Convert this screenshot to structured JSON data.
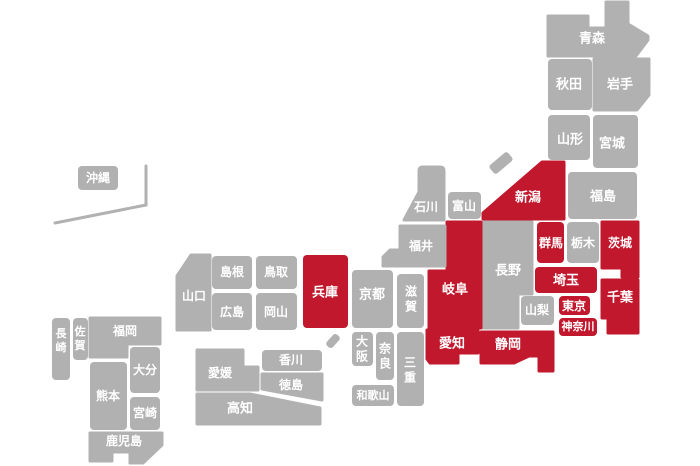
{
  "map": {
    "background": "#ffffff",
    "colors": {
      "prefecture_default": "#b1b1b1",
      "prefecture_highlight": "#c2182d",
      "label_text": "#ffffff",
      "okinawa_line": "#b1b1b1"
    },
    "highlighted_prefectures": [
      "新潟",
      "群馬",
      "茨城",
      "埼玉",
      "東京",
      "神奈川",
      "千葉",
      "静岡",
      "愛知",
      "岐阜",
      "兵庫"
    ],
    "prefectures": [
      {
        "id": "aomori",
        "name": "青森",
        "highlight": false,
        "shape": {
          "type": "path",
          "d": "M548,16 H588 V28 H606 V2 H628 V24 L648,36 V40 L636,56 H548 Z"
        },
        "label": {
          "x": 592,
          "y": 38,
          "fs": 13,
          "orient": "h"
        }
      },
      {
        "id": "akita",
        "name": "秋田",
        "highlight": false,
        "shape": {
          "type": "rect",
          "x": 548,
          "y": 59,
          "w": 44,
          "h": 51
        },
        "label": {
          "x": 569,
          "y": 84,
          "fs": 13,
          "orient": "h"
        }
      },
      {
        "id": "iwate",
        "name": "岩手",
        "highlight": false,
        "shape": {
          "type": "path",
          "d": "M594,59 H649 V95 L637,110 H594 Z"
        },
        "label": {
          "x": 620,
          "y": 84,
          "fs": 13,
          "orient": "h"
        }
      },
      {
        "id": "yamagata",
        "name": "山形",
        "highlight": false,
        "shape": {
          "type": "rect",
          "x": 548,
          "y": 115,
          "w": 42,
          "h": 45
        },
        "label": {
          "x": 570,
          "y": 139,
          "fs": 13,
          "orient": "h"
        }
      },
      {
        "id": "miyagi",
        "name": "宮城",
        "highlight": false,
        "shape": {
          "type": "rect",
          "x": 593,
          "y": 115,
          "w": 45,
          "h": 53
        },
        "label": {
          "x": 612,
          "y": 143,
          "fs": 13,
          "orient": "h"
        }
      },
      {
        "id": "fukushima",
        "name": "福島",
        "highlight": false,
        "shape": {
          "type": "rect",
          "x": 568,
          "y": 172,
          "w": 69,
          "h": 47
        },
        "label": {
          "x": 603,
          "y": 196,
          "fs": 13,
          "orient": "h"
        }
      },
      {
        "id": "niigata",
        "name": "新潟",
        "highlight": true,
        "shape": {
          "type": "path",
          "d": "M483,213 L542,162 H564 V219 H483 Z"
        },
        "label": {
          "x": 528,
          "y": 197,
          "fs": 13,
          "orient": "h"
        }
      },
      {
        "id": "gunma",
        "name": "群馬",
        "highlight": true,
        "shape": {
          "type": "rect",
          "x": 537,
          "y": 222,
          "w": 27,
          "h": 41
        },
        "label": {
          "x": 551,
          "y": 243,
          "fs": 12,
          "orient": "h"
        }
      },
      {
        "id": "tochigi",
        "name": "栃木",
        "highlight": false,
        "shape": {
          "type": "rect",
          "x": 567,
          "y": 222,
          "w": 32,
          "h": 41
        },
        "label": {
          "x": 583,
          "y": 243,
          "fs": 12,
          "orient": "h"
        }
      },
      {
        "id": "ibaraki",
        "name": "茨城",
        "highlight": true,
        "shape": {
          "type": "path",
          "d": "M602,222 H638 V277 H622 V268 H602 Z"
        },
        "label": {
          "x": 620,
          "y": 243,
          "fs": 12,
          "orient": "h"
        }
      },
      {
        "id": "saitama",
        "name": "埼玉",
        "highlight": true,
        "shape": {
          "type": "rect",
          "x": 535,
          "y": 267,
          "w": 62,
          "h": 26
        },
        "label": {
          "x": 566,
          "y": 280,
          "fs": 13,
          "orient": "h"
        }
      },
      {
        "id": "tokyo",
        "name": "東京",
        "highlight": true,
        "shape": {
          "type": "rect",
          "x": 559,
          "y": 296,
          "w": 31,
          "h": 19
        },
        "label": {
          "x": 574,
          "y": 306,
          "fs": 12,
          "orient": "h"
        }
      },
      {
        "id": "kanagawa",
        "name": "神奈川",
        "highlight": true,
        "shape": {
          "type": "rect",
          "x": 559,
          "y": 318,
          "w": 38,
          "h": 18
        },
        "label": {
          "x": 578,
          "y": 327,
          "fs": 11,
          "orient": "h"
        }
      },
      {
        "id": "chiba",
        "name": "千葉",
        "highlight": true,
        "shape": {
          "type": "path",
          "d": "M602,280 H638 V333 H608 V318 H602 Z"
        },
        "label": {
          "x": 620,
          "y": 297,
          "fs": 13,
          "orient": "h"
        }
      },
      {
        "id": "yamanashi",
        "name": "山梨",
        "highlight": false,
        "shape": {
          "type": "rect",
          "x": 521,
          "y": 296,
          "w": 33,
          "h": 29
        },
        "label": {
          "x": 537,
          "y": 310,
          "fs": 12,
          "orient": "h"
        }
      },
      {
        "id": "nagano",
        "name": "長野",
        "highlight": false,
        "shape": {
          "type": "path",
          "d": "M483,222 H532 V294 H518 V328 H483 Z"
        },
        "label": {
          "x": 508,
          "y": 270,
          "fs": 13,
          "orient": "h"
        }
      },
      {
        "id": "gifu",
        "name": "岐阜",
        "highlight": true,
        "shape": {
          "type": "path",
          "d": "M447,222 H481 V328 H429 V271 H447 Z"
        },
        "label": {
          "x": 455,
          "y": 289,
          "fs": 13,
          "orient": "h"
        }
      },
      {
        "id": "shizuoka",
        "name": "静岡",
        "highlight": true,
        "shape": {
          "type": "path",
          "d": "M481,332 H553 V371 H539 V356 H529 L514,363 H481 Z"
        },
        "label": {
          "x": 508,
          "y": 344,
          "fs": 13,
          "orient": "h"
        }
      },
      {
        "id": "aichi",
        "name": "愛知",
        "highlight": true,
        "shape": {
          "type": "path",
          "d": "M427,330 H478 V353 H458 V363 H430 L427,359 Z"
        },
        "label": {
          "x": 452,
          "y": 343,
          "fs": 13,
          "orient": "h"
        }
      },
      {
        "id": "toyama",
        "name": "富山",
        "highlight": false,
        "shape": {
          "type": "rect",
          "x": 448,
          "y": 192,
          "w": 33,
          "h": 27
        },
        "label": {
          "x": 464,
          "y": 206,
          "fs": 12,
          "orient": "h"
        }
      },
      {
        "id": "ishikawa",
        "name": "石川",
        "highlight": false,
        "shape": {
          "type": "path",
          "d": "M404,220 L419,192 V171 Q419,167 423,167 H440 Q444,167 444,171 V220 Z"
        },
        "label": {
          "x": 426,
          "y": 207,
          "fs": 12,
          "orient": "h"
        }
      },
      {
        "id": "fukui",
        "name": "福井",
        "highlight": false,
        "shape": {
          "type": "path",
          "d": "M400,226 H445 V266 H383 V257 L390,250 H400 Z"
        },
        "label": {
          "x": 421,
          "y": 246,
          "fs": 12,
          "orient": "h"
        }
      },
      {
        "id": "shiga",
        "name": "滋賀",
        "highlight": false,
        "shape": {
          "type": "rect",
          "x": 397,
          "y": 274,
          "w": 27,
          "h": 54
        },
        "label": {
          "x": 411,
          "y": 299,
          "fs": 12,
          "orient": "v"
        }
      },
      {
        "id": "kyoto",
        "name": "京都",
        "highlight": false,
        "shape": {
          "type": "rect",
          "x": 352,
          "y": 270,
          "w": 41,
          "h": 58
        },
        "label": {
          "x": 372,
          "y": 294,
          "fs": 13,
          "orient": "h"
        }
      },
      {
        "id": "osaka",
        "name": "大阪",
        "highlight": false,
        "shape": {
          "type": "rect",
          "x": 352,
          "y": 332,
          "w": 21,
          "h": 34
        },
        "label": {
          "x": 362,
          "y": 349,
          "fs": 12,
          "orient": "v"
        }
      },
      {
        "id": "nara",
        "name": "奈良",
        "highlight": false,
        "shape": {
          "type": "rect",
          "x": 376,
          "y": 332,
          "w": 18,
          "h": 48
        },
        "label": {
          "x": 385,
          "y": 356,
          "fs": 12,
          "orient": "v"
        }
      },
      {
        "id": "wakayama",
        "name": "和歌山",
        "highlight": false,
        "shape": {
          "type": "rect",
          "x": 352,
          "y": 385,
          "w": 42,
          "h": 21
        },
        "label": {
          "x": 373,
          "y": 396,
          "fs": 11,
          "orient": "h"
        }
      },
      {
        "id": "mie",
        "name": "三重",
        "highlight": false,
        "shape": {
          "type": "rect",
          "x": 397,
          "y": 332,
          "w": 27,
          "h": 74
        },
        "label": {
          "x": 410,
          "y": 370,
          "fs": 12,
          "orient": "v"
        }
      },
      {
        "id": "hyogo",
        "name": "兵庫",
        "highlight": true,
        "shape": {
          "type": "rect",
          "x": 303,
          "y": 255,
          "w": 45,
          "h": 73
        },
        "label": {
          "x": 325,
          "y": 292,
          "fs": 13,
          "orient": "h"
        }
      },
      {
        "id": "tottori",
        "name": "鳥取",
        "highlight": false,
        "shape": {
          "type": "rect",
          "x": 256,
          "y": 256,
          "w": 41,
          "h": 33
        },
        "label": {
          "x": 276,
          "y": 272,
          "fs": 12,
          "orient": "h"
        }
      },
      {
        "id": "shimane",
        "name": "島根",
        "highlight": false,
        "shape": {
          "type": "rect",
          "x": 212,
          "y": 256,
          "w": 40,
          "h": 33
        },
        "label": {
          "x": 232,
          "y": 272,
          "fs": 12,
          "orient": "h"
        }
      },
      {
        "id": "okayama",
        "name": "岡山",
        "highlight": false,
        "shape": {
          "type": "rect",
          "x": 256,
          "y": 293,
          "w": 41,
          "h": 37
        },
        "label": {
          "x": 276,
          "y": 312,
          "fs": 12,
          "orient": "h"
        }
      },
      {
        "id": "hiroshima",
        "name": "広島",
        "highlight": false,
        "shape": {
          "type": "rect",
          "x": 212,
          "y": 293,
          "w": 40,
          "h": 37
        },
        "label": {
          "x": 232,
          "y": 312,
          "fs": 12,
          "orient": "h"
        }
      },
      {
        "id": "yamaguchi",
        "name": "山口",
        "highlight": false,
        "shape": {
          "type": "path",
          "d": "M191,255 H210 V330 H177 V276 Z"
        },
        "label": {
          "x": 194,
          "y": 296,
          "fs": 12,
          "orient": "h"
        }
      },
      {
        "id": "kagawa",
        "name": "香川",
        "highlight": false,
        "shape": {
          "type": "rect",
          "x": 262,
          "y": 350,
          "w": 60,
          "h": 21
        },
        "label": {
          "x": 291,
          "y": 360,
          "fs": 12,
          "orient": "h"
        }
      },
      {
        "id": "tokushima",
        "name": "徳島",
        "highlight": false,
        "shape": {
          "type": "path",
          "d": "M262,374 H322 V400 L262,389 Z"
        },
        "label": {
          "x": 291,
          "y": 385,
          "fs": 12,
          "orient": "h"
        }
      },
      {
        "id": "ehime",
        "name": "愛媛",
        "highlight": false,
        "shape": {
          "type": "path",
          "d": "M197,350 H243 V367 H258 V390 H197 Z"
        },
        "label": {
          "x": 220,
          "y": 373,
          "fs": 12,
          "orient": "h"
        }
      },
      {
        "id": "kochi",
        "name": "高知",
        "highlight": false,
        "shape": {
          "type": "path",
          "d": "M197,394 H250 L320,408 V424 H197 Z"
        },
        "label": {
          "x": 240,
          "y": 408,
          "fs": 13,
          "orient": "h"
        }
      },
      {
        "id": "fukuoka",
        "name": "福岡",
        "highlight": false,
        "shape": {
          "type": "path",
          "d": "M90,318 H160 V344 H127 V357 H90 Z"
        },
        "label": {
          "x": 125,
          "y": 331,
          "fs": 12,
          "orient": "h"
        }
      },
      {
        "id": "saga",
        "name": "佐賀",
        "highlight": false,
        "shape": {
          "type": "rect",
          "x": 73,
          "y": 318,
          "w": 15,
          "h": 42
        },
        "label": {
          "x": 80,
          "y": 339,
          "fs": 11,
          "orient": "v"
        }
      },
      {
        "id": "nagasaki",
        "name": "長崎",
        "highlight": false,
        "shape": {
          "type": "rect",
          "x": 52,
          "y": 318,
          "w": 18,
          "h": 62
        },
        "label": {
          "x": 61,
          "y": 341,
          "fs": 11,
          "orient": "v"
        }
      },
      {
        "id": "kumamoto",
        "name": "熊本",
        "highlight": false,
        "shape": {
          "type": "rect",
          "x": 90,
          "y": 362,
          "w": 37,
          "h": 68
        },
        "label": {
          "x": 108,
          "y": 396,
          "fs": 12,
          "orient": "h"
        }
      },
      {
        "id": "oita",
        "name": "大分",
        "highlight": false,
        "shape": {
          "type": "rect",
          "x": 130,
          "y": 347,
          "w": 30,
          "h": 46
        },
        "label": {
          "x": 145,
          "y": 370,
          "fs": 12,
          "orient": "h"
        }
      },
      {
        "id": "miyazaki",
        "name": "宮崎",
        "highlight": false,
        "shape": {
          "type": "rect",
          "x": 130,
          "y": 397,
          "w": 30,
          "h": 33
        },
        "label": {
          "x": 145,
          "y": 413,
          "fs": 12,
          "orient": "h"
        }
      },
      {
        "id": "kagoshima",
        "name": "鹿児島",
        "highlight": false,
        "shape": {
          "type": "path",
          "d": "M90,433 H162 V445 L143,463 H130 V452 H112 V461 H90 Z"
        },
        "label": {
          "x": 124,
          "y": 441,
          "fs": 12,
          "orient": "h"
        }
      },
      {
        "id": "okinawa",
        "name": "沖縄",
        "highlight": false,
        "shape": {
          "type": "rect",
          "x": 78,
          "y": 166,
          "w": 40,
          "h": 24
        },
        "label": {
          "x": 98,
          "y": 178,
          "fs": 12,
          "orient": "h"
        }
      }
    ],
    "islands": [
      {
        "id": "sado-island",
        "cx": 501,
        "cy": 163,
        "w": 24,
        "h": 11,
        "angle": -40
      },
      {
        "id": "awaji-island",
        "cx": 333,
        "cy": 341,
        "w": 15,
        "h": 8,
        "angle": -48
      }
    ],
    "okinawa_boundary_line": {
      "points": [
        [
          55,
          223
        ],
        [
          146,
          205
        ],
        [
          146,
          166
        ]
      ],
      "width": 3
    }
  }
}
